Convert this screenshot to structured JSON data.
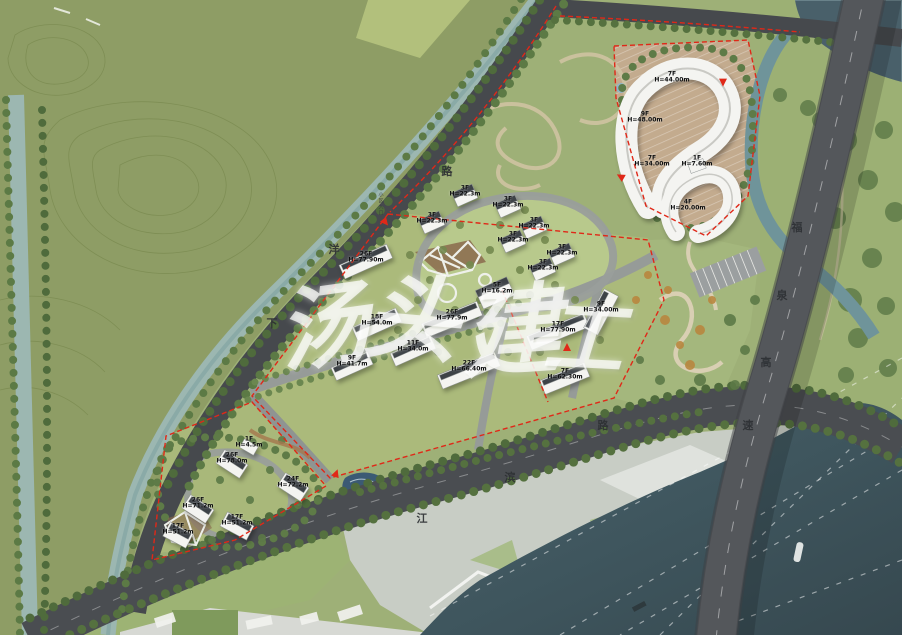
{
  "document": {
    "type": "site-plan",
    "description": "Aerial master-plan rendering of a riverside residential development"
  },
  "watermark": {
    "text": "汤头建工",
    "chars": [
      {
        "char": "汤",
        "x": 322,
        "y": 320,
        "rot": -8,
        "size": 90
      },
      {
        "char": "头",
        "x": 412,
        "y": 312,
        "rot": 5,
        "size": 94
      },
      {
        "char": "建",
        "x": 510,
        "y": 324,
        "rot": -4,
        "size": 98
      },
      {
        "char": "工",
        "x": 584,
        "y": 332,
        "rot": 3,
        "size": 80
      }
    ]
  },
  "road_names": {
    "xiayang_road": "下洋路",
    "jiangbin_road": "江滨路",
    "fuquan_expressway": "福泉高速"
  },
  "road_labels": [
    {
      "road": "xiayang_road",
      "char": "下",
      "x": 272,
      "y": 323
    },
    {
      "road": "xiayang_road",
      "char": "洋",
      "x": 334,
      "y": 249
    },
    {
      "road": "xiayang_road",
      "char": "路",
      "x": 447,
      "y": 171
    },
    {
      "road": "jiangbin_road",
      "char": "江",
      "x": 422,
      "y": 518
    },
    {
      "road": "jiangbin_road",
      "char": "滨",
      "x": 510,
      "y": 477
    },
    {
      "road": "jiangbin_road",
      "char": "路",
      "x": 603,
      "y": 425
    },
    {
      "road": "fuquan_expressway",
      "char": "福",
      "x": 797,
      "y": 227
    },
    {
      "road": "fuquan_expressway",
      "char": "泉",
      "x": 782,
      "y": 295
    },
    {
      "road": "fuquan_expressway",
      "char": "高",
      "x": 766,
      "y": 362
    },
    {
      "road": "fuquan_expressway",
      "char": "速",
      "x": 748,
      "y": 425
    }
  ],
  "buildings": [
    {
      "floors": "7F",
      "height": "H=44.00m",
      "x": 672,
      "y": 78
    },
    {
      "floors": "9F",
      "height": "H=48.00m",
      "x": 645,
      "y": 118
    },
    {
      "floors": "7F",
      "height": "H=34.00m",
      "x": 652,
      "y": 162
    },
    {
      "floors": "1F",
      "height": "H=7.60m",
      "x": 697,
      "y": 162
    },
    {
      "floors": "4F",
      "height": "H=20.00m",
      "x": 688,
      "y": 206
    },
    {
      "floors": "3F",
      "height": "H=22.3m",
      "x": 465,
      "y": 192
    },
    {
      "floors": "3F",
      "height": "H=22.3m",
      "x": 508,
      "y": 203
    },
    {
      "floors": "3F",
      "height": "H=22.3m",
      "x": 534,
      "y": 224
    },
    {
      "floors": "3F",
      "height": "H=22.3m",
      "x": 562,
      "y": 251
    },
    {
      "floors": "3F",
      "height": "H=22.3m",
      "x": 513,
      "y": 238
    },
    {
      "floors": "3F",
      "height": "H=22.3m",
      "x": 543,
      "y": 266
    },
    {
      "floors": "3F",
      "height": "H=22.3m",
      "x": 432,
      "y": 219
    },
    {
      "floors": "5F",
      "height": "H=16.2m",
      "x": 497,
      "y": 289
    },
    {
      "floors": "26F",
      "height": "H=77.90m",
      "x": 366,
      "y": 258
    },
    {
      "floors": "18F",
      "height": "H=54.0m",
      "x": 377,
      "y": 321
    },
    {
      "floors": "26F",
      "height": "H=77.9m",
      "x": 452,
      "y": 316
    },
    {
      "floors": "11F",
      "height": "H=34.0m",
      "x": 413,
      "y": 347
    },
    {
      "floors": "9F",
      "height": "H=41.7m",
      "x": 352,
      "y": 362
    },
    {
      "floors": "17F",
      "height": "H=77.90m",
      "x": 558,
      "y": 328
    },
    {
      "floors": "9F",
      "height": "H=34.00m",
      "x": 601,
      "y": 308
    },
    {
      "floors": "22F",
      "height": "H=66.40m",
      "x": 469,
      "y": 367
    },
    {
      "floors": "7F",
      "height": "H=62.30m",
      "x": 565,
      "y": 375
    },
    {
      "floors": "1F",
      "height": "H=4.5m",
      "x": 249,
      "y": 443
    },
    {
      "floors": "26F",
      "height": "H=78.0m",
      "x": 232,
      "y": 459
    },
    {
      "floors": "26F",
      "height": "H=71.2m",
      "x": 198,
      "y": 504
    },
    {
      "floors": "24F",
      "height": "H=72.2m",
      "x": 293,
      "y": 483
    },
    {
      "floors": "17F",
      "height": "H=51.2m",
      "x": 237,
      "y": 521
    },
    {
      "floors": "17F",
      "height": "H=51.2m",
      "x": 178,
      "y": 530
    }
  ],
  "annotations": [
    {
      "text": "小区入口",
      "x": 381,
      "y": 204
    }
  ],
  "entrances": [
    {
      "x": 385,
      "y": 221,
      "rot": 140
    },
    {
      "x": 567,
      "y": 347,
      "rot": 0
    },
    {
      "x": 723,
      "y": 81,
      "rot": 180
    },
    {
      "x": 621,
      "y": 176,
      "rot": 300
    },
    {
      "x": 336,
      "y": 473,
      "rot": 20
    }
  ],
  "colors": {
    "hillside_green": "#8e9d65",
    "parcel_lawn": "#abba7b",
    "road_gray": "#4a4d51",
    "expressway_gray": "#54575b",
    "canal_teal": "#9cb7b1",
    "river_teal": "#3f565e",
    "boundary_red": "#e02818",
    "building_white": "#f4f4f1",
    "building_roof": "#3d4247",
    "watermark_white": "#ffffff"
  }
}
